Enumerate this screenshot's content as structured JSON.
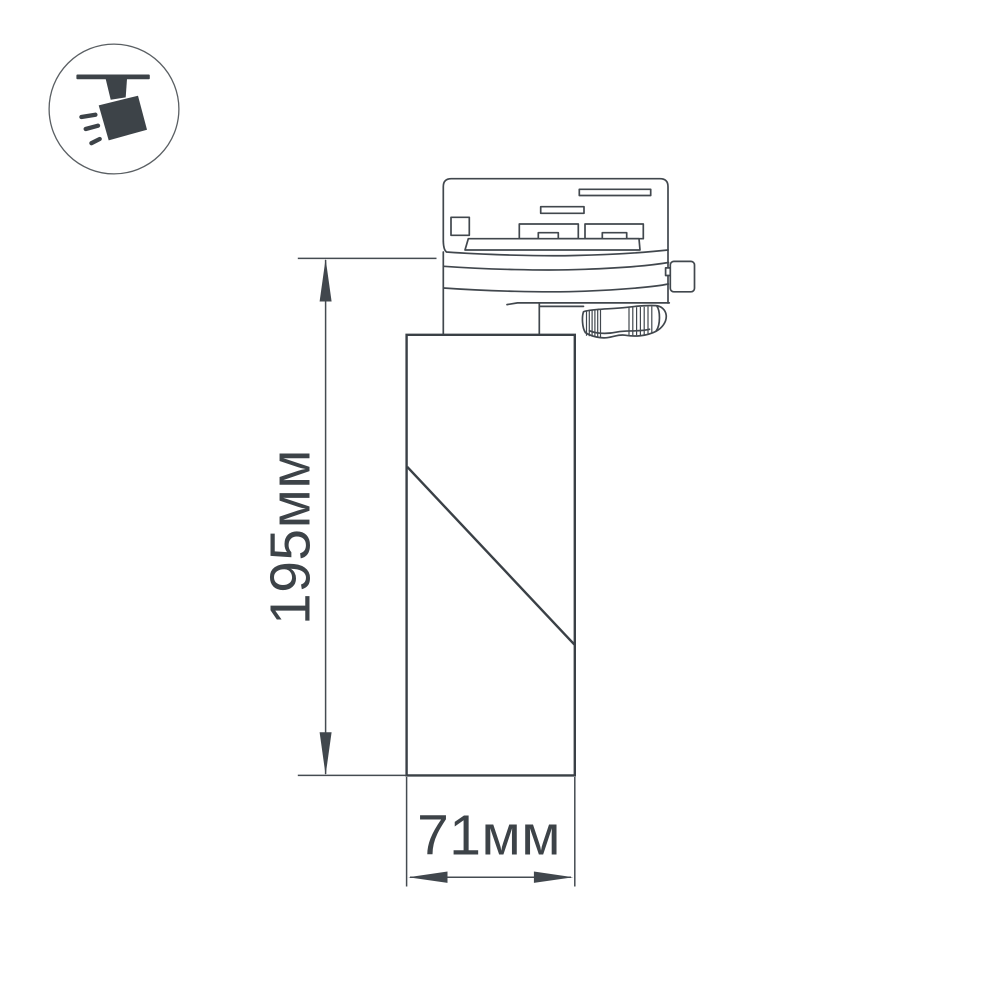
{
  "page": {
    "background": "#ffffff"
  },
  "badge": {
    "icon": "track-spotlight-icon",
    "meaning": "ceiling-track-mounted-spotlight"
  },
  "dimensions": {
    "height": {
      "label": "195мм",
      "value_mm": 195,
      "unit": "мм",
      "axis": "vertical"
    },
    "width": {
      "label": "71мм",
      "value_mm": 71,
      "unit": "мм",
      "axis": "horizontal"
    }
  },
  "colors": {
    "line": "#41474d",
    "body_line": "#3a4046",
    "dimension_line": "#454b51",
    "text": "#3d4348",
    "icon": "#3d4348",
    "background": "#ffffff"
  }
}
